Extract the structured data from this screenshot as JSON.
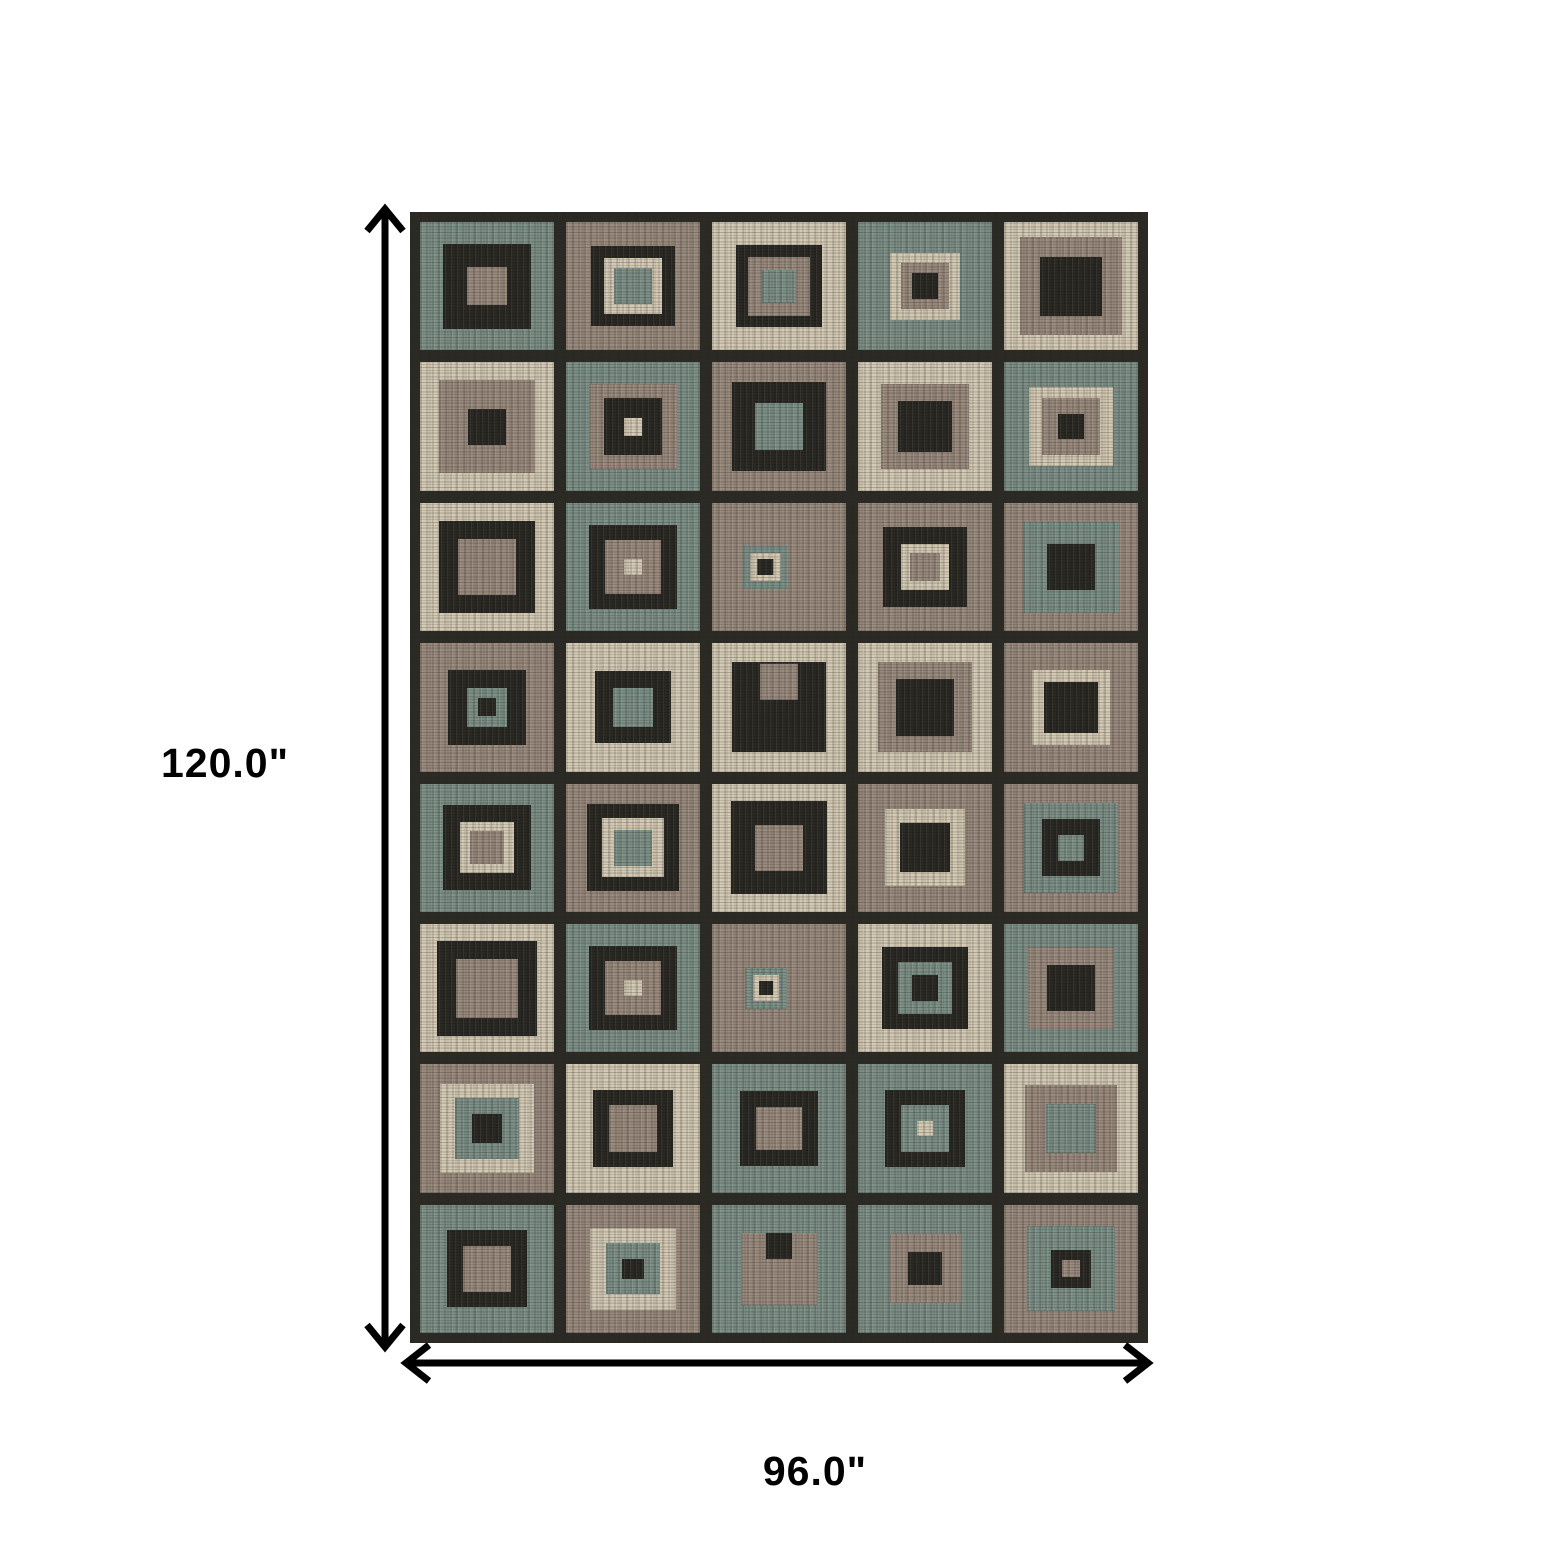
{
  "figure": {
    "height_label": "120.0\"",
    "width_label": "96.0\"",
    "arrow_color": "#000000",
    "background_color": "#ffffff"
  },
  "rug": {
    "rows": 8,
    "columns": 5,
    "grid_color": "#2b2a25",
    "palette": {
      "k": "#2a2924",
      "t": "#7d9087",
      "p": "#9a8a7d",
      "b": "#d4cab4"
    },
    "cells": [
      [
        {
          "c": "t",
          "s": 1
        },
        {
          "c": "k",
          "s": 0.66
        },
        {
          "c": "p",
          "s": 0.3
        }
      ],
      [
        {
          "c": "p",
          "s": 1
        },
        {
          "c": "k",
          "s": 0.62
        },
        {
          "c": "b",
          "s": 0.44
        },
        {
          "c": "t",
          "s": 0.28
        }
      ],
      [
        {
          "c": "b",
          "s": 1
        },
        {
          "c": "k",
          "s": 0.64
        },
        {
          "c": "p",
          "s": 0.46
        },
        {
          "c": "t",
          "s": 0.26
        }
      ],
      [
        {
          "c": "t",
          "s": 1
        },
        {
          "c": "b",
          "s": 0.52
        },
        {
          "c": "p",
          "s": 0.36
        },
        {
          "c": "k",
          "s": 0.2
        }
      ],
      [
        {
          "c": "b",
          "s": 1
        },
        {
          "c": "p",
          "s": 0.76
        },
        {
          "c": "k",
          "s": 0.46
        }
      ],
      [
        {
          "c": "b",
          "s": 1
        },
        {
          "c": "p",
          "s": 0.72
        },
        {
          "c": "k",
          "s": 0.28
        }
      ],
      [
        {
          "c": "t",
          "s": 1
        },
        {
          "c": "p",
          "s": 0.66
        },
        {
          "c": "k",
          "s": 0.44
        },
        {
          "c": "b",
          "s": 0.14
        }
      ],
      [
        {
          "c": "p",
          "s": 1
        },
        {
          "c": "k",
          "s": 0.7
        },
        {
          "c": "t",
          "s": 0.36
        }
      ],
      [
        {
          "c": "b",
          "s": 1
        },
        {
          "c": "p",
          "s": 0.66
        },
        {
          "c": "k",
          "s": 0.4
        }
      ],
      [
        {
          "c": "t",
          "s": 1
        },
        {
          "c": "b",
          "s": 0.62
        },
        {
          "c": "p",
          "s": 0.44
        },
        {
          "c": "k",
          "s": 0.2
        }
      ],
      [
        {
          "c": "b",
          "s": 1
        },
        {
          "c": "k",
          "s": 0.72
        },
        {
          "c": "p",
          "s": 0.44
        }
      ],
      [
        {
          "c": "t",
          "s": 1
        },
        {
          "c": "k",
          "s": 0.66
        },
        {
          "c": "p",
          "s": 0.42
        },
        {
          "c": "b",
          "s": 0.13
        }
      ],
      [
        {
          "c": "p",
          "s": 1
        },
        {
          "c": "t",
          "s": 0.34,
          "dx": -30
        },
        {
          "c": "b",
          "s": 0.22
        },
        {
          "c": "k",
          "s": 0.12
        }
      ],
      [
        {
          "c": "p",
          "s": 1
        },
        {
          "c": "k",
          "s": 0.62
        },
        {
          "c": "b",
          "s": 0.36
        },
        {
          "c": "p",
          "s": 0.22
        }
      ],
      [
        {
          "c": "p",
          "s": 1
        },
        {
          "c": "t",
          "s": 0.72
        },
        {
          "c": "k",
          "s": 0.36
        }
      ],
      [
        {
          "c": "p",
          "s": 1
        },
        {
          "c": "k",
          "s": 0.58
        },
        {
          "c": "t",
          "s": 0.3
        },
        {
          "c": "k",
          "s": 0.14
        }
      ],
      [
        {
          "c": "b",
          "s": 1
        },
        {
          "c": "k",
          "s": 0.56
        },
        {
          "c": "t",
          "s": 0.3
        }
      ],
      [
        {
          "c": "b",
          "s": 1
        },
        {
          "c": "k",
          "s": 0.7
        },
        {
          "c": "p",
          "s": 0.28,
          "dy": -70
        }
      ],
      [
        {
          "c": "b",
          "s": 1
        },
        {
          "c": "p",
          "s": 0.7
        },
        {
          "c": "k",
          "s": 0.44
        }
      ],
      [
        {
          "c": "p",
          "s": 1
        },
        {
          "c": "b",
          "s": 0.58
        },
        {
          "c": "k",
          "s": 0.4
        }
      ],
      [
        {
          "c": "t",
          "s": 1
        },
        {
          "c": "k",
          "s": 0.66
        },
        {
          "c": "b",
          "s": 0.4
        },
        {
          "c": "p",
          "s": 0.26
        }
      ],
      [
        {
          "c": "p",
          "s": 1
        },
        {
          "c": "k",
          "s": 0.68
        },
        {
          "c": "b",
          "s": 0.46
        },
        {
          "c": "t",
          "s": 0.28
        }
      ],
      [
        {
          "c": "b",
          "s": 1
        },
        {
          "c": "k",
          "s": 0.72
        },
        {
          "c": "p",
          "s": 0.36
        }
      ],
      [
        {
          "c": "p",
          "s": 1
        },
        {
          "c": "b",
          "s": 0.6
        },
        {
          "c": "k",
          "s": 0.38
        }
      ],
      [
        {
          "c": "p",
          "s": 1
        },
        {
          "c": "t",
          "s": 0.7
        },
        {
          "c": "k",
          "s": 0.44
        },
        {
          "c": "t",
          "s": 0.2
        }
      ],
      [
        {
          "c": "b",
          "s": 1
        },
        {
          "c": "k",
          "s": 0.74
        },
        {
          "c": "p",
          "s": 0.46
        }
      ],
      [
        {
          "c": "t",
          "s": 1
        },
        {
          "c": "k",
          "s": 0.66
        },
        {
          "c": "p",
          "s": 0.42
        },
        {
          "c": "b",
          "s": 0.13
        }
      ],
      [
        {
          "c": "p",
          "s": 1
        },
        {
          "c": "t",
          "s": 0.32,
          "dx": -30
        },
        {
          "c": "b",
          "s": 0.2
        },
        {
          "c": "k",
          "s": 0.11
        }
      ],
      [
        {
          "c": "b",
          "s": 1
        },
        {
          "c": "k",
          "s": 0.64
        },
        {
          "c": "t",
          "s": 0.4
        },
        {
          "c": "k",
          "s": 0.2
        }
      ],
      [
        {
          "c": "t",
          "s": 1
        },
        {
          "c": "p",
          "s": 0.64
        },
        {
          "c": "k",
          "s": 0.36
        }
      ],
      [
        {
          "c": "p",
          "s": 1
        },
        {
          "c": "b",
          "s": 0.7
        },
        {
          "c": "t",
          "s": 0.48
        },
        {
          "c": "k",
          "s": 0.22
        }
      ],
      [
        {
          "c": "b",
          "s": 1
        },
        {
          "c": "k",
          "s": 0.6
        },
        {
          "c": "p",
          "s": 0.36
        }
      ],
      [
        {
          "c": "t",
          "s": 1
        },
        {
          "c": "k",
          "s": 0.58
        },
        {
          "c": "p",
          "s": 0.34
        }
      ],
      [
        {
          "c": "t",
          "s": 1
        },
        {
          "c": "k",
          "s": 0.6
        },
        {
          "c": "t",
          "s": 0.36
        },
        {
          "c": "b",
          "s": 0.12
        }
      ],
      [
        {
          "c": "b",
          "s": 1
        },
        {
          "c": "p",
          "s": 0.68
        },
        {
          "c": "t",
          "s": 0.38
        }
      ],
      [
        {
          "c": "t",
          "s": 1
        },
        {
          "c": "k",
          "s": 0.6
        },
        {
          "c": "p",
          "s": 0.36
        }
      ],
      [
        {
          "c": "p",
          "s": 1
        },
        {
          "c": "b",
          "s": 0.64
        },
        {
          "c": "t",
          "s": 0.4
        },
        {
          "c": "k",
          "s": 0.16
        }
      ],
      [
        {
          "c": "t",
          "s": 1
        },
        {
          "c": "p",
          "s": 0.56
        },
        {
          "c": "k",
          "s": 0.2,
          "dy": -90
        }
      ],
      [
        {
          "c": "t",
          "s": 1
        },
        {
          "c": "p",
          "s": 0.54
        },
        {
          "c": "k",
          "s": 0.26
        }
      ],
      [
        {
          "c": "p",
          "s": 1
        },
        {
          "c": "t",
          "s": 0.66
        },
        {
          "c": "k",
          "s": 0.3
        },
        {
          "c": "p",
          "s": 0.13
        }
      ]
    ]
  }
}
